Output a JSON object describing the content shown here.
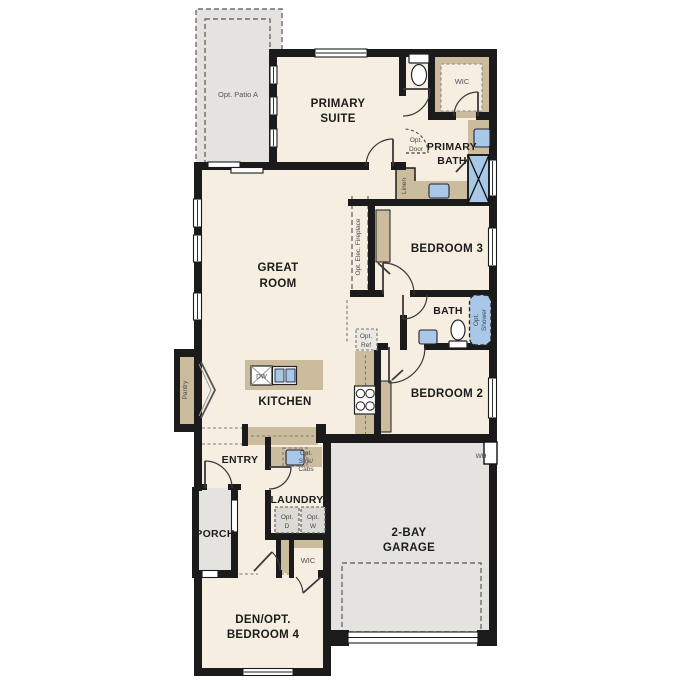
{
  "plan_title": "Single story floor plan",
  "colors": {
    "room_fill": "#f6eee0",
    "optional_area_fill": "#e4e3df",
    "cabinet_fill": "#ccbc9e",
    "fixture_blue": "#a9c7e6",
    "wall": "#1b1b1b"
  },
  "labels": {
    "patio": "Opt. Patio A",
    "primary_suite": [
      "PRIMARY",
      "SUITE"
    ],
    "wic_primary": "WIC",
    "primary_bath": [
      "PRIMARY",
      "BATH"
    ],
    "opt_door": [
      "Opt.",
      "Door"
    ],
    "linen": "Linen",
    "great_room": [
      "GREAT",
      "ROOM"
    ],
    "opt_fireplace": "Opt. Elec. Fireplace",
    "bedroom3": "BEDROOM 3",
    "bath": "BATH",
    "opt_shower": [
      "Opt.",
      "Shower"
    ],
    "opt_ref": [
      "Opt.",
      "Ref"
    ],
    "kitchen": "KITCHEN",
    "dw": "DW",
    "bedroom2": "BEDROOM 2",
    "entry": "ENTRY",
    "opt_sink": [
      "Opt.",
      "Sink/",
      "Cabs"
    ],
    "laundry": "LAUNDRY",
    "opt_d": [
      "Opt.",
      "D"
    ],
    "opt_w": [
      "Opt.",
      "W"
    ],
    "porch": "PORCH",
    "wic_den": "WIC",
    "den": [
      "DEN/OPT.",
      "BEDROOM 4"
    ],
    "garage": [
      "2-BAY",
      "GARAGE"
    ],
    "wh": "WH",
    "pantry": "Pantry"
  }
}
